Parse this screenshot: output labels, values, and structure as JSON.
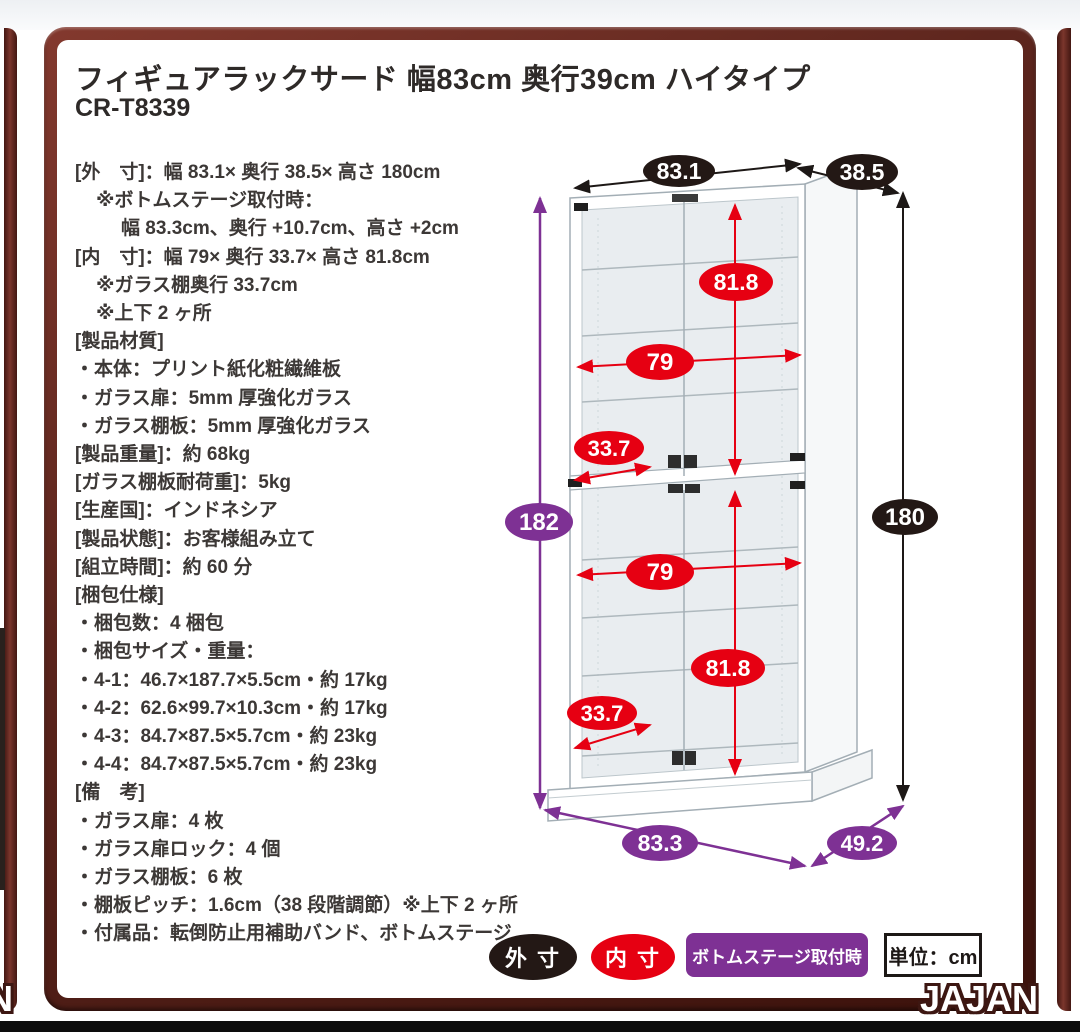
{
  "header": {
    "title": "フィギュアラックサード 幅83cm 奥行39cm ハイタイプ",
    "model": "CR-T8339"
  },
  "specs": {
    "lines": [
      "[外　寸]：幅 83.1× 奥行 38.5× 高さ 180cm",
      "※ボトムステージ取付時：",
      "幅 83.3cm、奥行 +10.7cm、高さ +2cm",
      "[内　寸]：幅 79× 奥行 33.7× 高さ 81.8cm",
      "※ガラス棚奥行 33.7cm",
      "※上下 2 ヶ所",
      "[製品材質]",
      "・本体：プリント紙化粧繊維板",
      "・ガラス扉：5mm 厚強化ガラス",
      "・ガラス棚板：5mm 厚強化ガラス",
      "[製品重量]：約 68kg",
      "[ガラス棚板耐荷重]：5kg",
      "[生産国]：インドネシア",
      "[製品状態]：お客様組み立て",
      "[組立時間]：約 60 分",
      "[梱包仕様]",
      "・梱包数：4 梱包",
      "・梱包サイズ・重量：",
      "・4-1：46.7×187.7×5.5cm・約 17kg",
      "・4-2：62.6×99.7×10.3cm・約 17kg",
      "・4-3：84.7×87.5×5.7cm・約 23kg",
      "・4-4：84.7×87.5×5.7cm・約 23kg",
      "[備　考]",
      "・ガラス扉：4 枚",
      "・ガラス扉ロック：4 個",
      "・ガラス棚板：6 枚",
      "・棚板ピッチ：1.6cm（38 段階調節）※上下 2 ヶ所",
      "・付属品：転倒防止用補助バンド、ボトムステージ"
    ]
  },
  "diagram": {
    "dims": {
      "outer_width": "83.1",
      "outer_depth": "38.5",
      "outer_height": "180",
      "stage_height": "182",
      "inner_height_upper": "81.8",
      "inner_height_lower": "81.8",
      "inner_width_upper": "79",
      "inner_width_lower": "79",
      "shelf_depth_upper": "33.7",
      "shelf_depth_lower": "33.7",
      "stage_width": "83.3",
      "stage_depth": "49.2"
    }
  },
  "legend": {
    "outer_label": "外 寸",
    "inner_label": "内 寸",
    "stage_label": "ボトムステージ取付時",
    "unit_label": "単位：cm"
  },
  "branding": {
    "logo": "JAJAN",
    "logo_fragment_left": "N"
  },
  "colors": {
    "outer_dim": "#231815",
    "inner_dim": "#e60012",
    "stage_dim": "#7e3194",
    "frame": "#5a241c"
  }
}
